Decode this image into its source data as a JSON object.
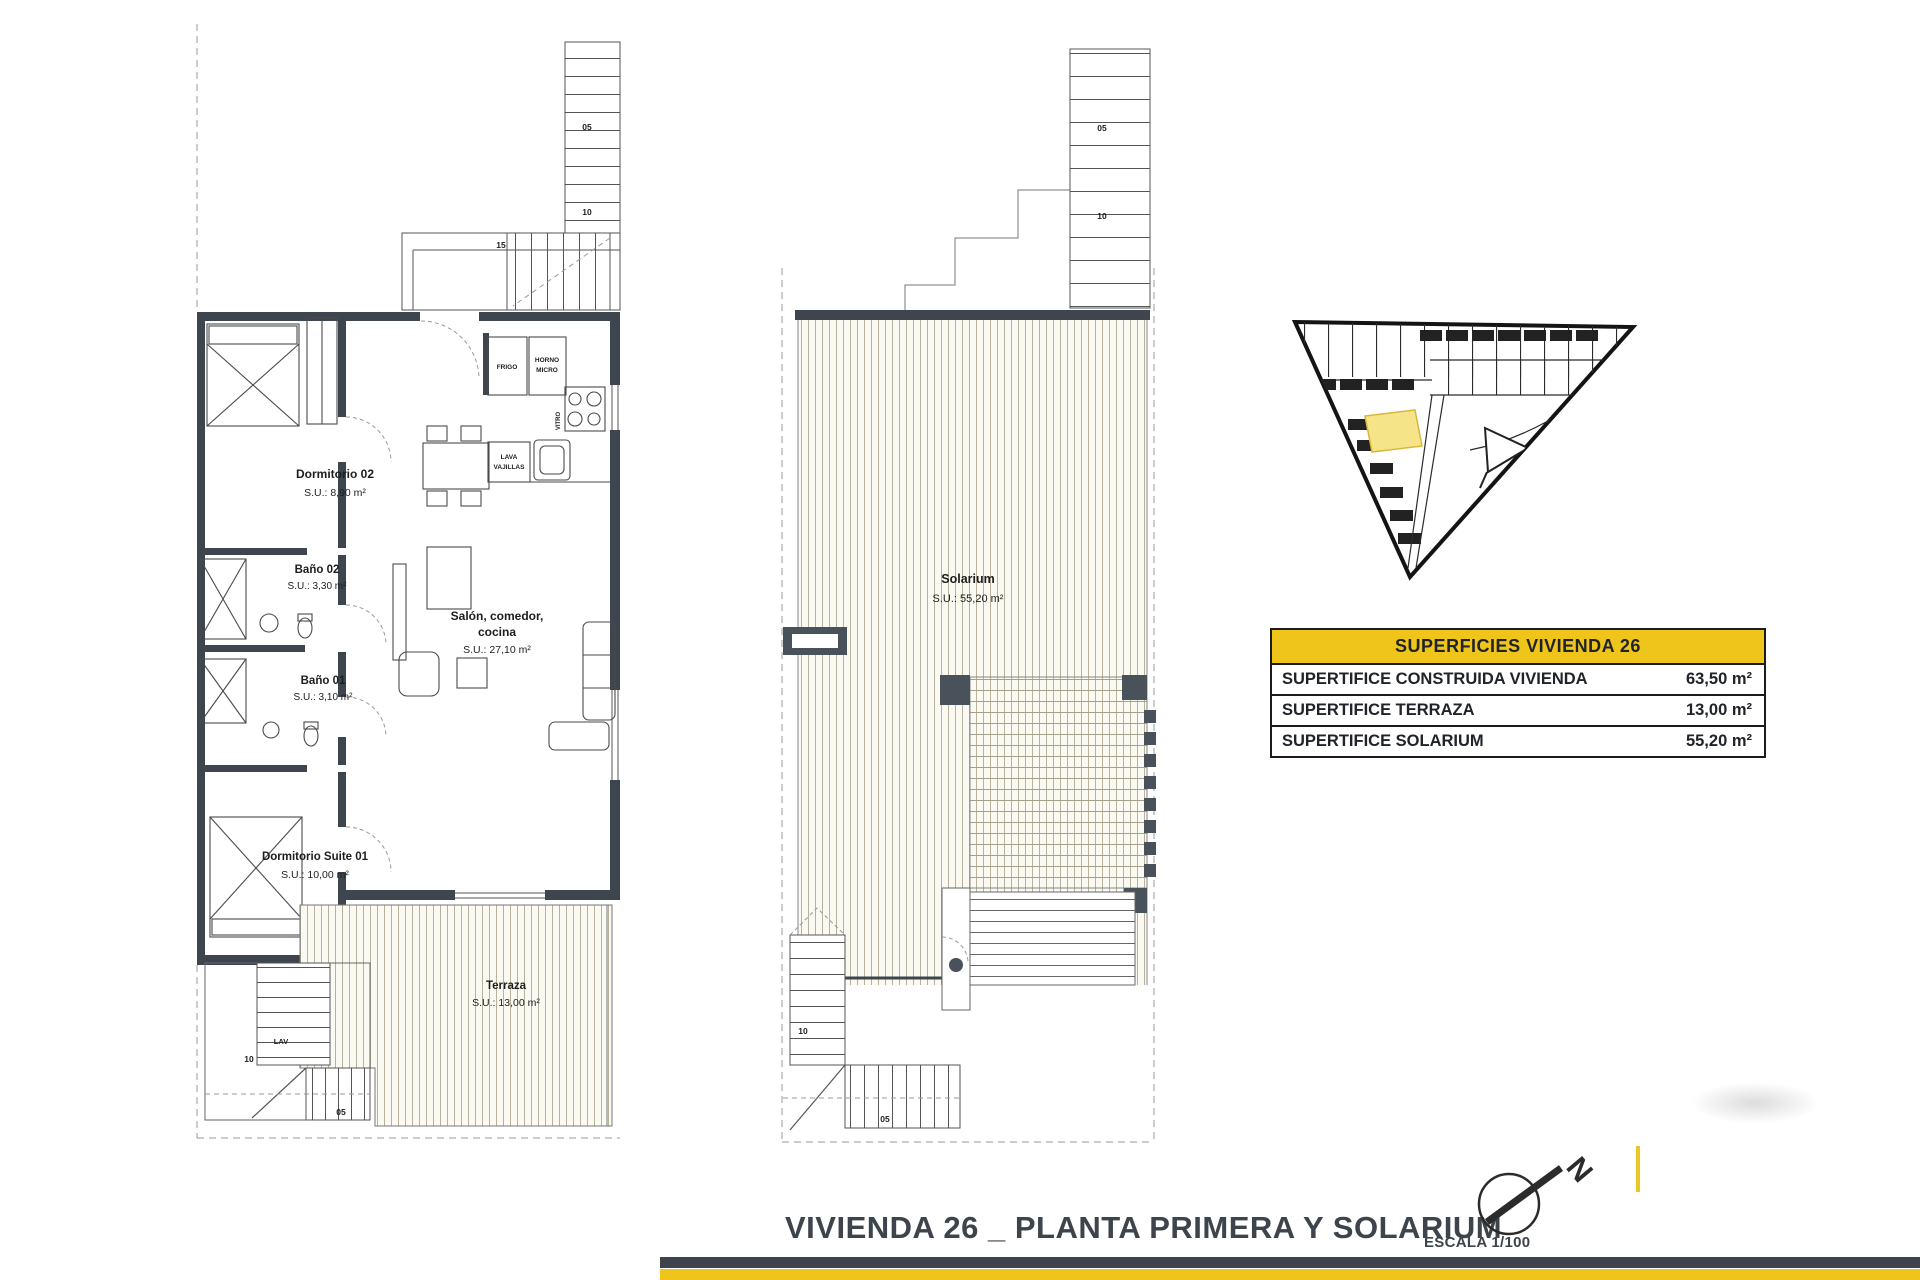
{
  "sheet": {
    "title": "VIVIENDA 26 _ PLANTA PRIMERA Y SOLARIUM",
    "scale": "ESCALA 1/100",
    "north": "N"
  },
  "surfaces_table": {
    "header": "SUPERFICIES VIVIENDA 26",
    "rows": [
      {
        "label": "SUPERTIFICE CONSTRUIDA VIVIENDA",
        "value": "63,50 m²"
      },
      {
        "label": "SUPERTIFICE TERRAZA",
        "value": "13,00 m²"
      },
      {
        "label": "SUPERTIFICE SOLARIUM",
        "value": "55,20 m²"
      }
    ]
  },
  "first_floor": {
    "rooms": {
      "dormitorio02": {
        "name": "Dormitorio 02",
        "area": "S.U.: 8,90 m²"
      },
      "bano02": {
        "name": "Baño 02",
        "area": "S.U.: 3,30 m²"
      },
      "bano01": {
        "name": "Baño 01",
        "area": "S.U.: 3,10 m²"
      },
      "salon": {
        "line1": "Salón, comedor,",
        "line2": "cocina",
        "area": "S.U.: 27,10 m²"
      },
      "suite": {
        "name": "Dormitorio Suite 01",
        "area": "S.U.: 10,00 m²"
      },
      "terraza": {
        "name": "Terraza",
        "area": "S.U.: 13,00 m²"
      }
    },
    "kitchen": {
      "frigo": "FRIGO",
      "horno1": "HORNO",
      "horno2": "MICRO",
      "vitro": "VITRO",
      "lava1": "LAVA",
      "lava2": "VAJILLAS"
    },
    "stairs": {
      "top_05": "05",
      "top_10": "10",
      "top_15": "15",
      "low_10": "10",
      "low_05": "05",
      "lav": "LAV"
    }
  },
  "solarium_floor": {
    "room": {
      "name": "Solarium",
      "area": "S.U.: 55,20 m²"
    },
    "stairs": {
      "top_05": "05",
      "top_10": "10",
      "low_10": "10",
      "low_05": "05"
    }
  }
}
